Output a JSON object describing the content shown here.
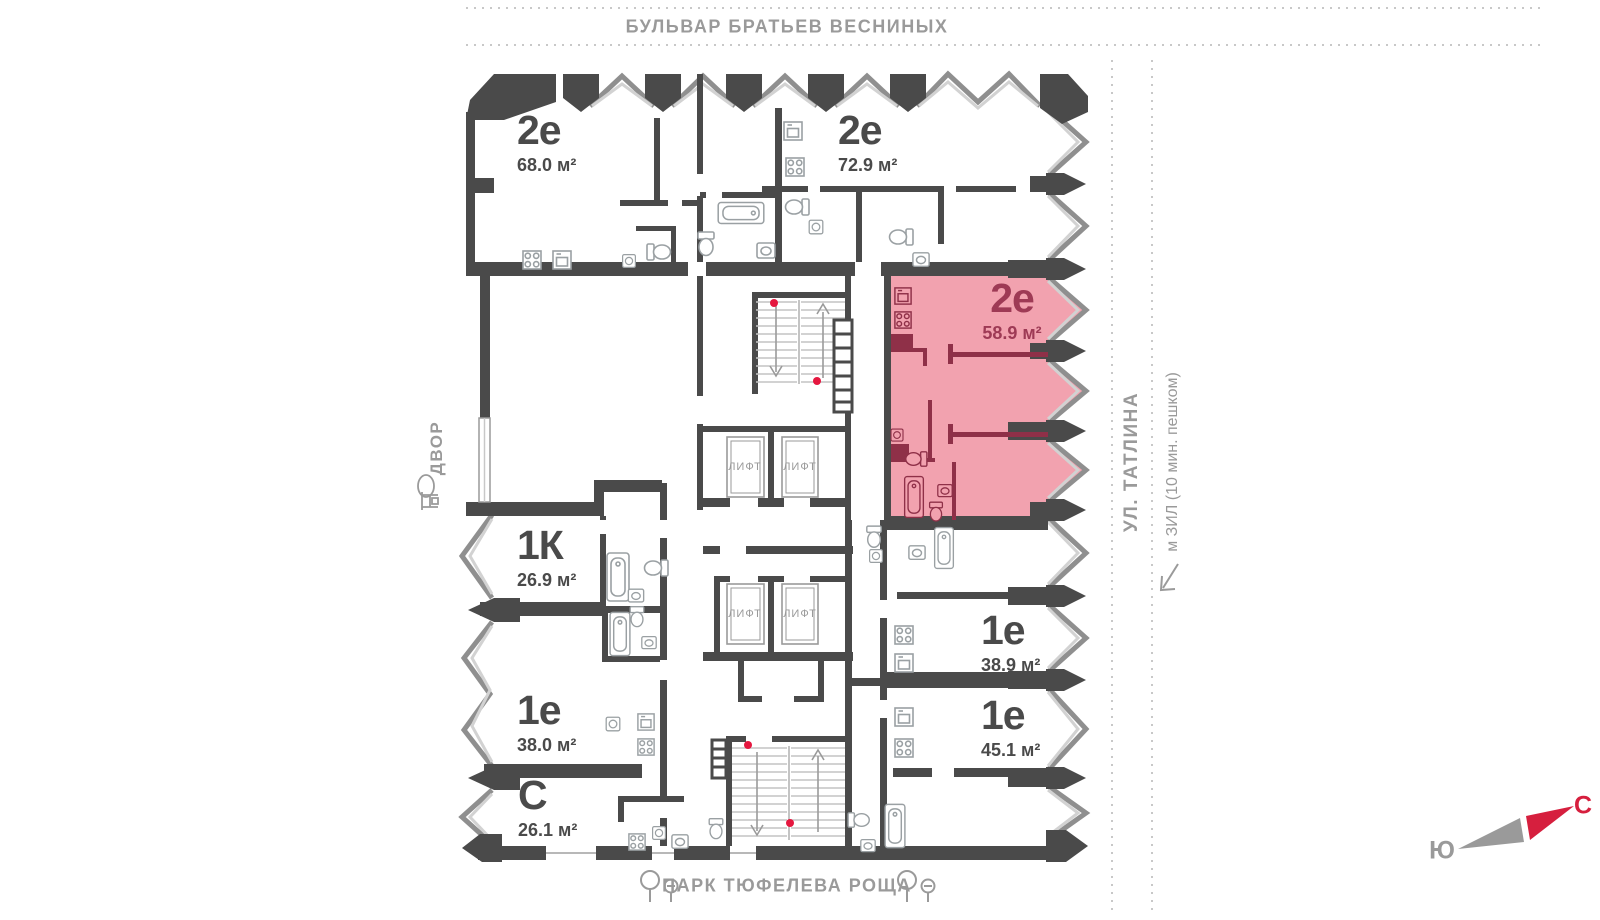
{
  "streets": {
    "top": "БУЛЬВАР БРАТЬЕВ ВЕСНИНЫХ",
    "left": "ДВОР",
    "right": "УЛ. ТАТЛИНА",
    "right_note": "м ЗИЛ (10 мин. пешком)",
    "bottom": "ПАРК ТЮФЕЛЕВА РОЩА"
  },
  "units": [
    {
      "type": "2е",
      "area": "68.0 м²",
      "highlighted": false
    },
    {
      "type": "2е",
      "area": "72.9 м²",
      "highlighted": false
    },
    {
      "type": "2е",
      "area": "58.9 м²",
      "highlighted": true
    },
    {
      "type": "1К",
      "area": "26.9 м²",
      "highlighted": false
    },
    {
      "type": "1е",
      "area": "38.0 м²",
      "highlighted": false
    },
    {
      "type": "С",
      "area": "26.1 м²",
      "highlighted": false
    },
    {
      "type": "1е",
      "area": "38.9 м²",
      "highlighted": false
    },
    {
      "type": "1е",
      "area": "45.1 м²",
      "highlighted": false
    }
  ],
  "core": {
    "elevator_label": "ЛИФТ"
  },
  "compass": {
    "north": "С",
    "south": "Ю"
  },
  "colors": {
    "wall": "#4a4a4a",
    "highlight_fill": "#f2a2af",
    "highlight_stroke": "#8f3048",
    "highlight_text": "#9e3a55",
    "fixture": "#9aa0a3",
    "street_text": "#9a9a9a",
    "stair_dot": "#e5173f",
    "compass_north": "#d61f3e"
  }
}
